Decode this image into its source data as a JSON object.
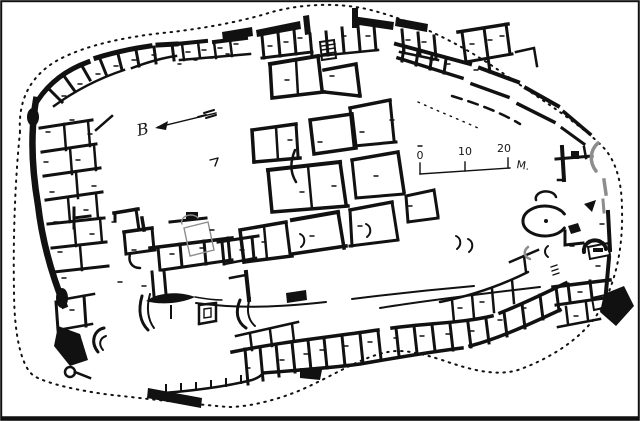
{
  "figure": {
    "kind": "archaeological-site-plan"
  },
  "scale_bar": {
    "labels": [
      "0",
      "10",
      "20"
    ],
    "unit": "M."
  },
  "orientation_marker": {
    "label": "B"
  },
  "colors": {
    "ink": "#111111",
    "faint_ink": "#8d8d8d",
    "paper": "#ffffff"
  }
}
